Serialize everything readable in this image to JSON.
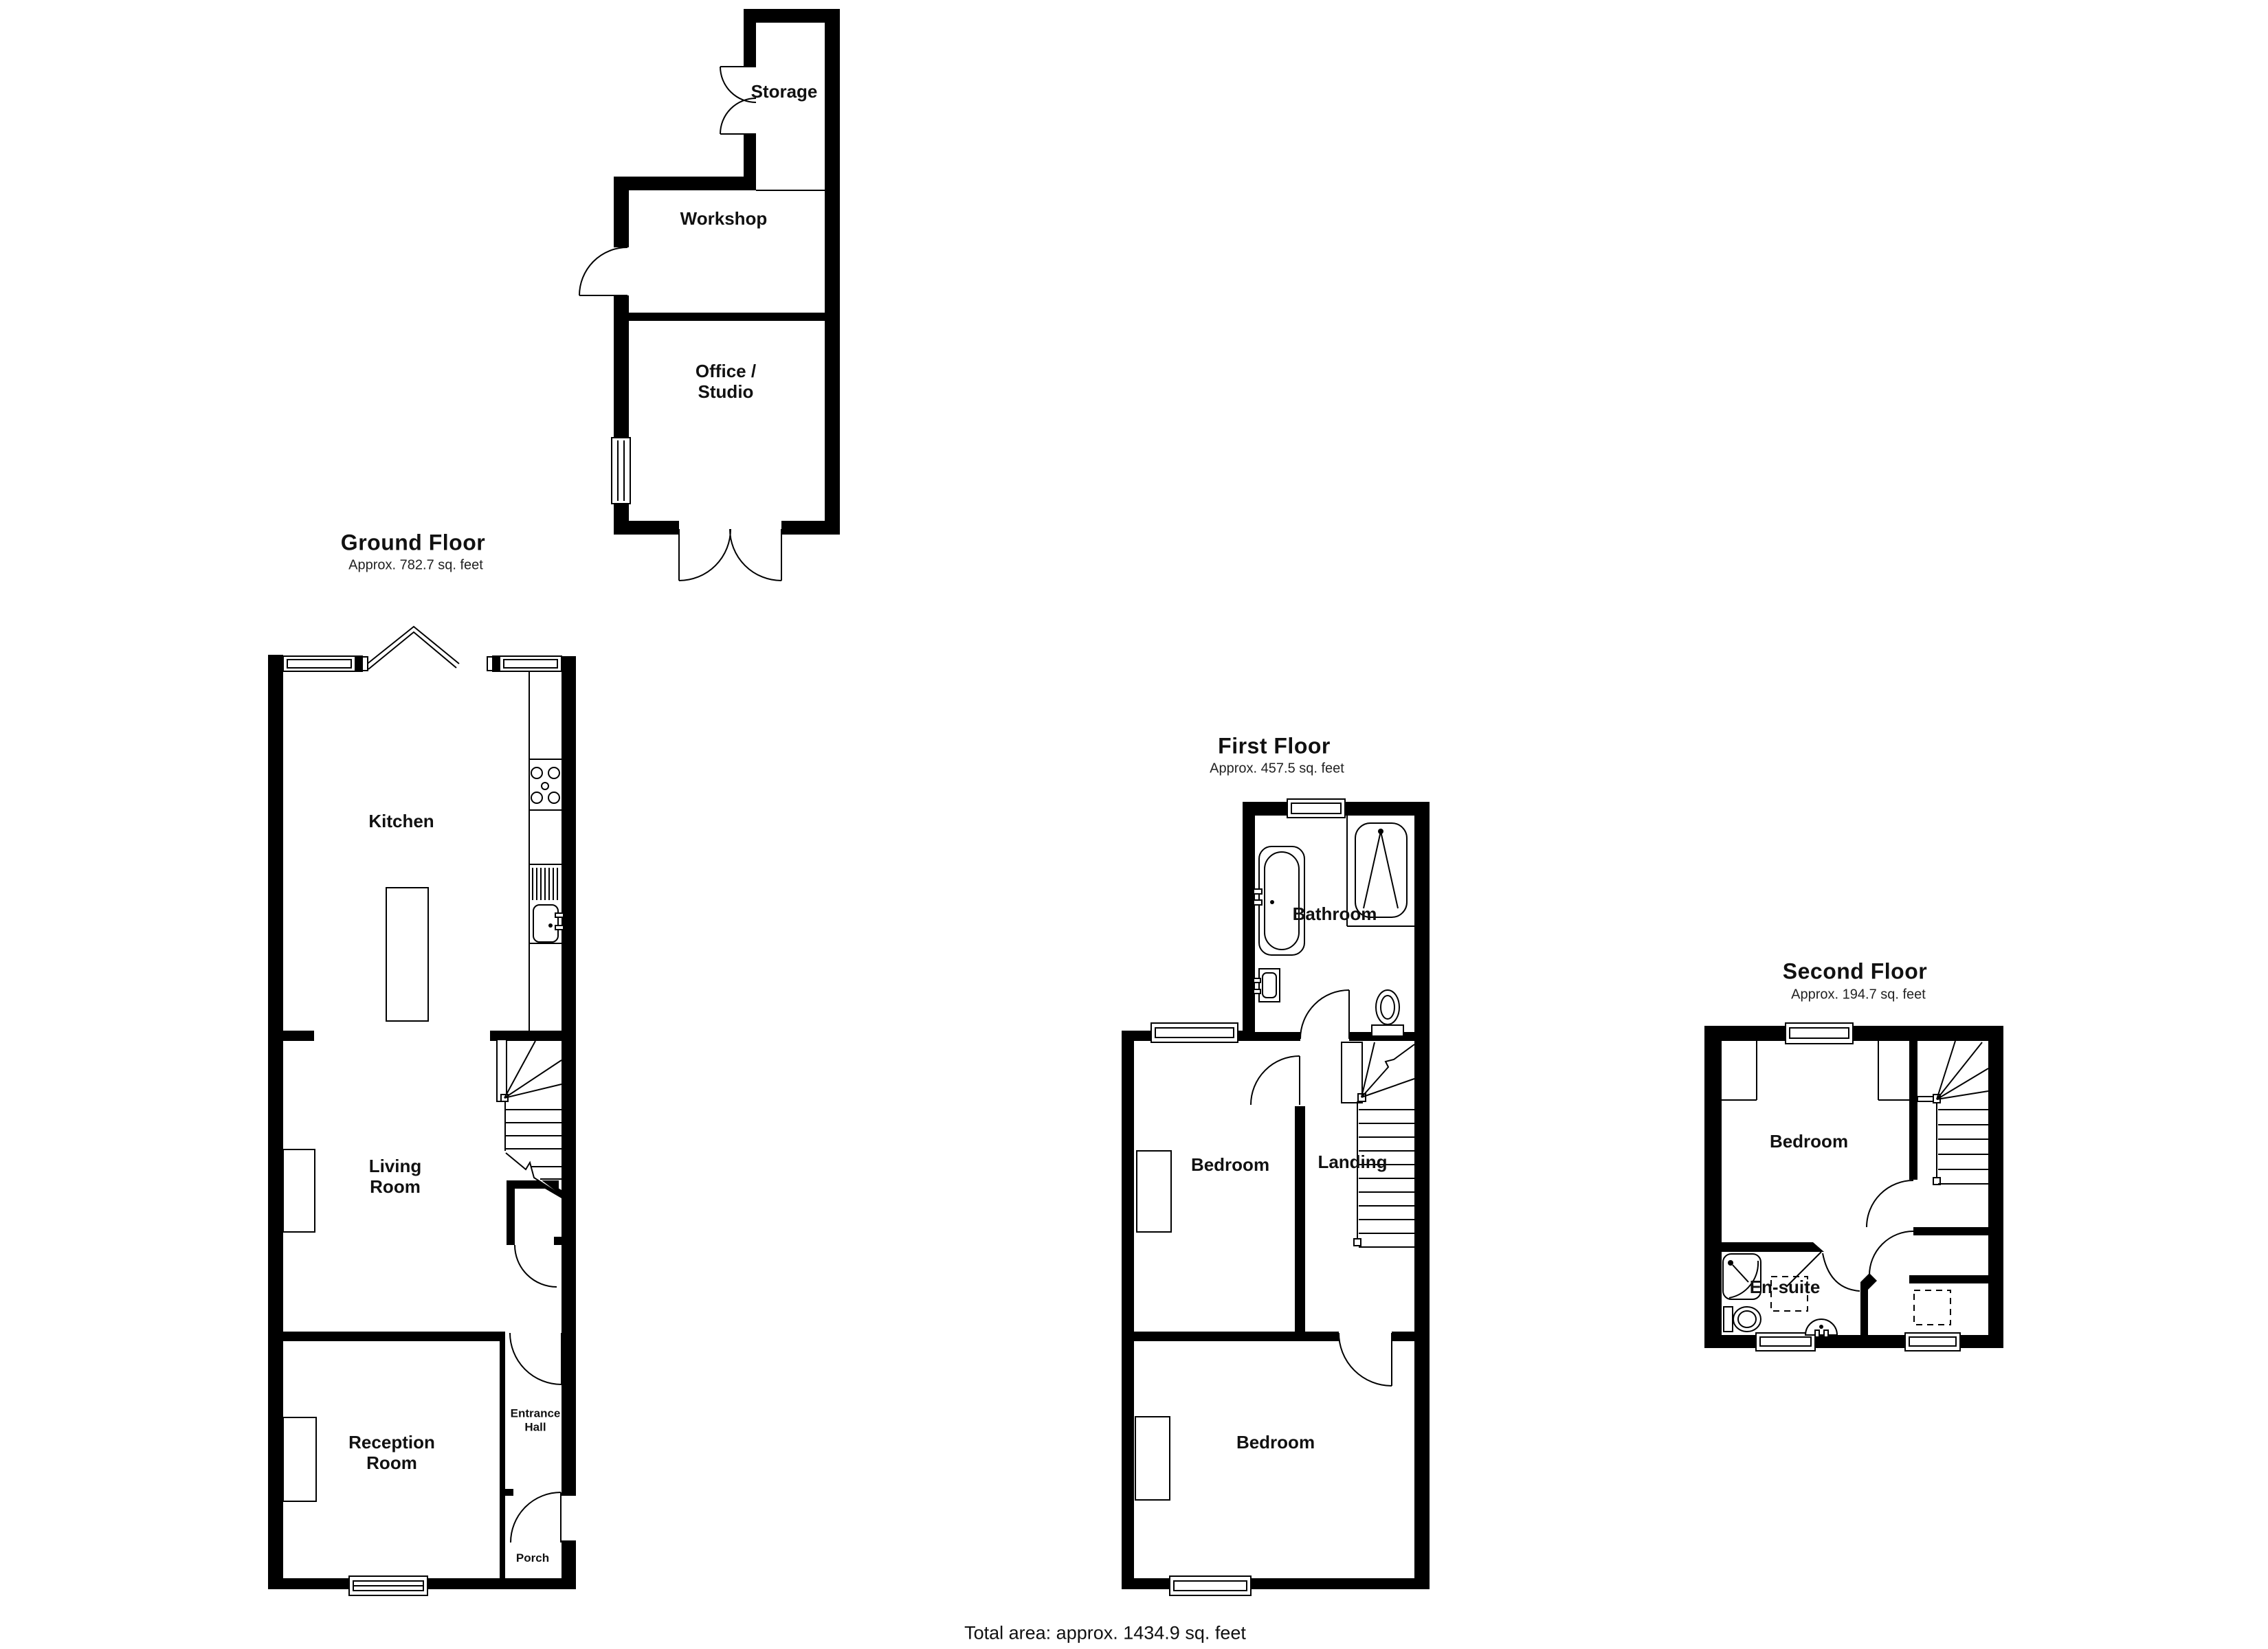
{
  "document": {
    "type": "floorplan",
    "background_color": "#ffffff",
    "wall_color": "#000000",
    "line_color": "#000000",
    "text_color": "#111111"
  },
  "floors": {
    "ground": {
      "title": "Ground Floor",
      "area": "Approx. 782.7 sq. feet",
      "rooms": {
        "storage": "Storage",
        "workshop": "Workshop",
        "office_studio": "Office /\nStudio",
        "kitchen": "Kitchen",
        "living_room": "Living\nRoom",
        "reception_room": "Reception\nRoom",
        "entrance_hall": "Entrance\nHall",
        "porch": "Porch"
      }
    },
    "first": {
      "title": "First Floor",
      "area": "Approx. 457.5 sq. feet",
      "rooms": {
        "bathroom": "Bathroom",
        "bedroom_front": "Bedroom",
        "landing": "Landing",
        "bedroom_back": "Bedroom"
      }
    },
    "second": {
      "title": "Second Floor",
      "area": "Approx. 194.7 sq. feet",
      "rooms": {
        "bedroom": "Bedroom",
        "ensuite": "En-suite"
      }
    }
  },
  "footer": {
    "total_area": "Total area: approx. 1434.9 sq. feet"
  }
}
